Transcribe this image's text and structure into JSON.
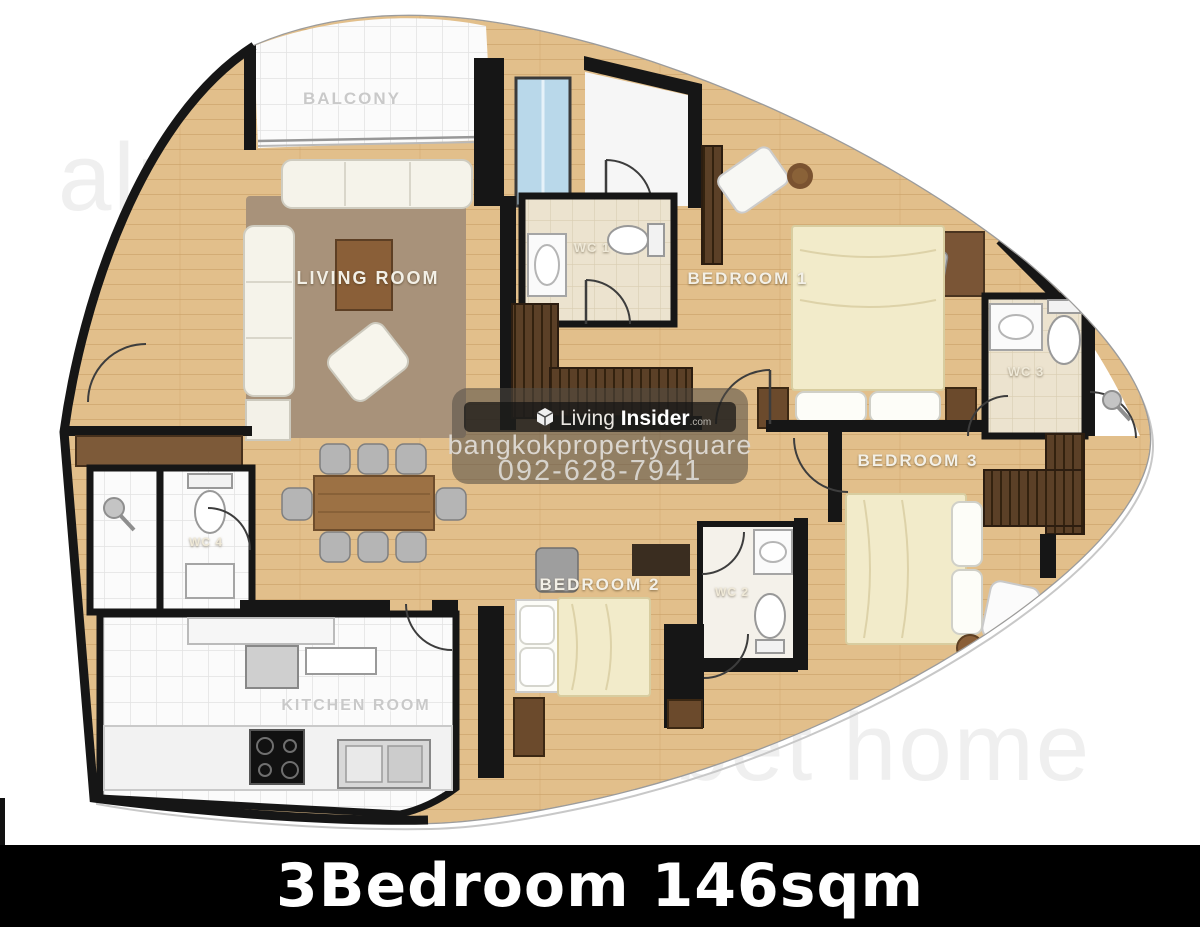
{
  "plan": {
    "rooms": [
      {
        "id": "balcony",
        "label": "BALCONY"
      },
      {
        "id": "living-room",
        "label": "LIVING ROOM"
      },
      {
        "id": "wc-1",
        "label": "WC 1"
      },
      {
        "id": "bedroom-1",
        "label": "BEDROOM 1"
      },
      {
        "id": "wc-3",
        "label": "WC 3"
      },
      {
        "id": "bedroom-3",
        "label": "BEDROOM 3"
      },
      {
        "id": "bedroom-2",
        "label": "BEDROOM 2"
      },
      {
        "id": "wc-2",
        "label": "WC 2"
      },
      {
        "id": "wc-4",
        "label": "WC 4"
      },
      {
        "id": "kitchen",
        "label": "KITCHEN ROOM"
      }
    ]
  },
  "watermarks": {
    "alphabet_top_left": "alphabet home",
    "alphabet_bottom_right": "alphabet home",
    "panel": {
      "logo_icon": "cube-icon",
      "brand_word1": "Living",
      "brand_word2": "Insider",
      "brand_tld": ".com",
      "site_name": "bangkokpropertysquare",
      "phone": "092-628-7941"
    }
  },
  "banner": {
    "title": "3Bedroom 146sqm"
  },
  "colors": {
    "wood_floor": "#e2bf8b",
    "wall_black": "#161616",
    "rug_brown": "#a8927a",
    "tile_beige": "#ece3cf",
    "window_blue": "#b9d8ea",
    "closet_brown": "#5b4027",
    "banner_bg": "#000000",
    "banner_text": "#ffffff"
  }
}
